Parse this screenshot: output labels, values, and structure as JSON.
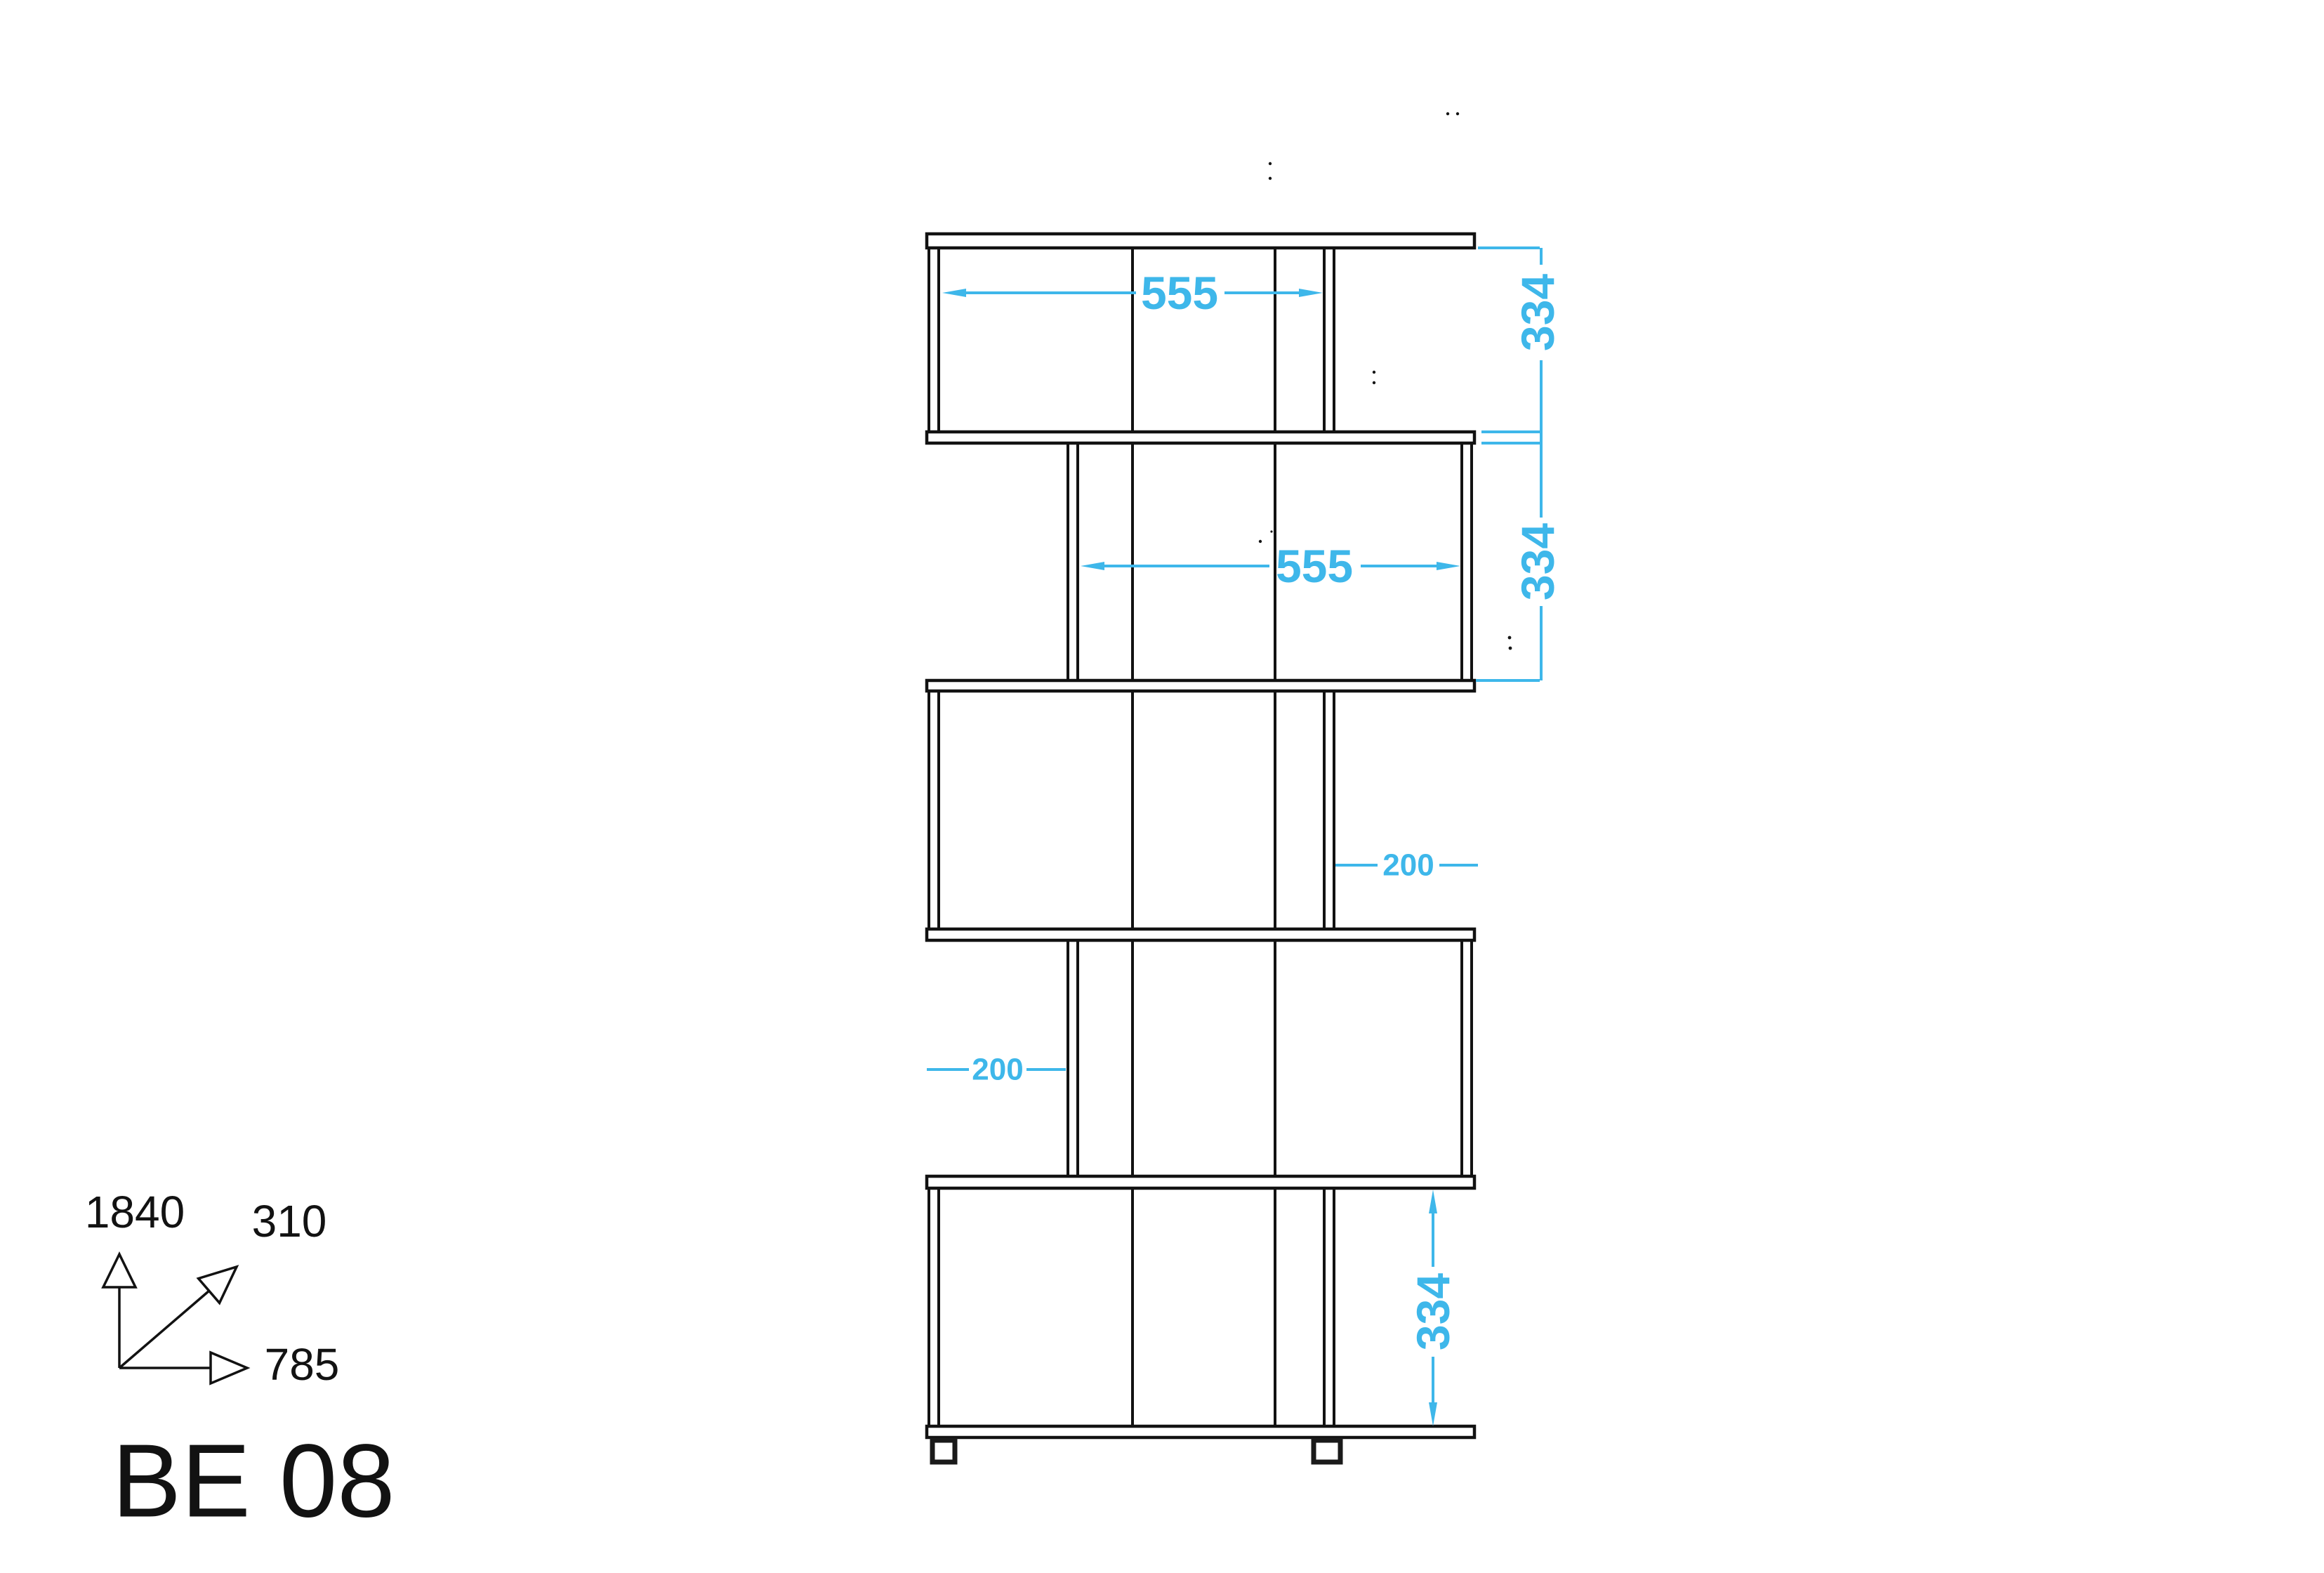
{
  "drawing": {
    "type": "furniture-technical-drawing",
    "model_code": "BE 08"
  },
  "dims": {
    "row1_width": "555",
    "row2_width": "555",
    "row1_height": "334",
    "row2_height": "334",
    "bottom_height": "334",
    "offset_right": "200",
    "offset_left": "200"
  },
  "axis": {
    "height": "1840",
    "depth": "310",
    "width": "785"
  },
  "colors": {
    "dimension_accent": "#3EB7EA",
    "line": "#121212",
    "background": "#FFFFFF"
  }
}
